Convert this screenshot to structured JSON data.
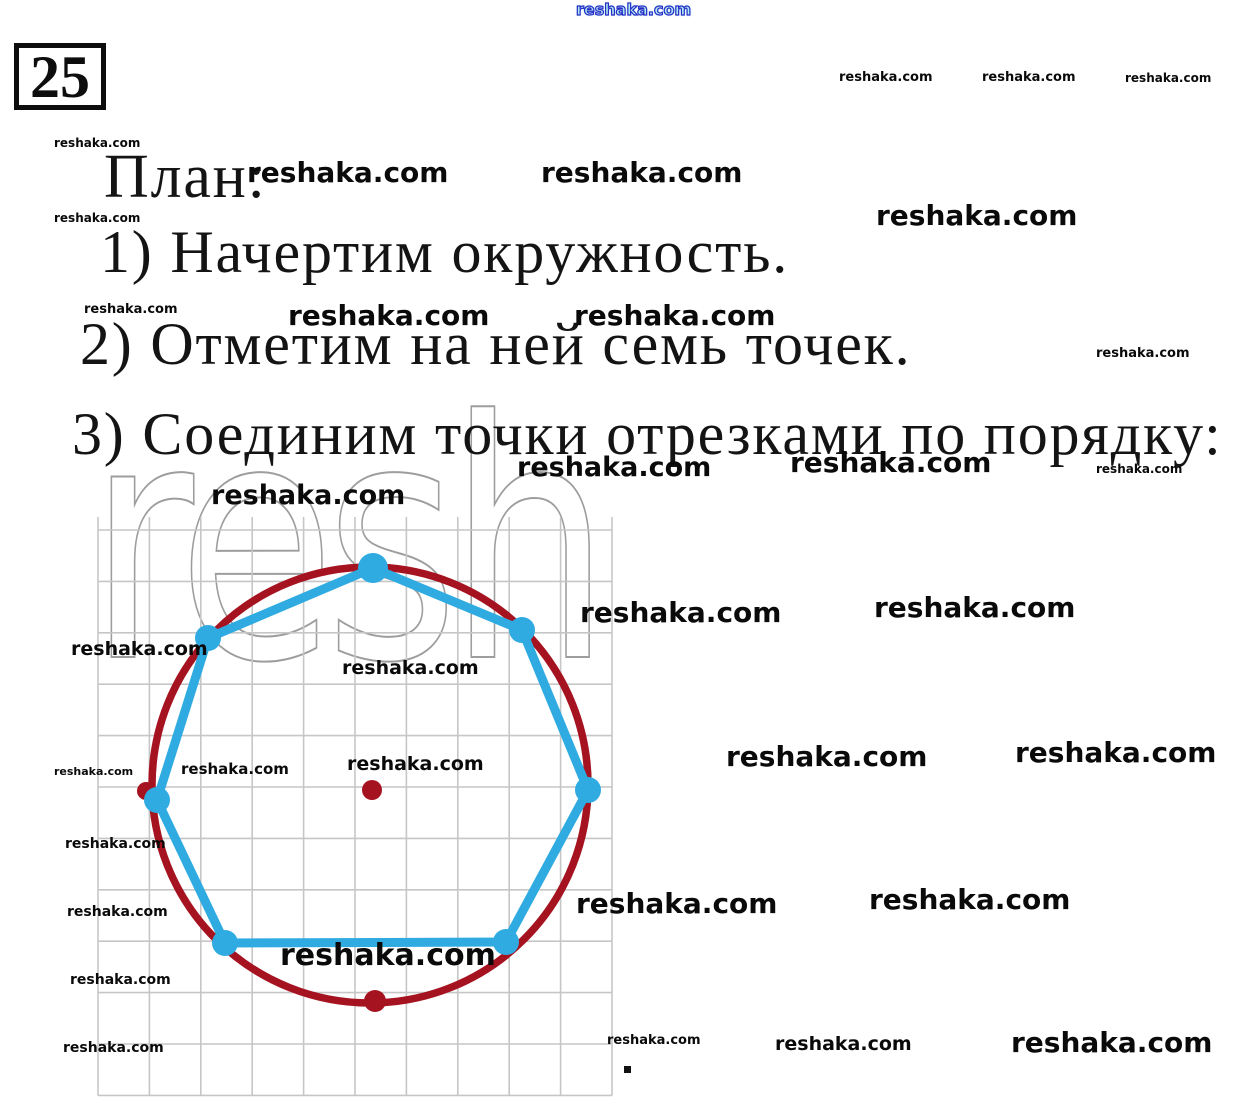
{
  "page": {
    "problem_number": "25",
    "plan_title": "План:",
    "steps": [
      "1) Начертим окружность.",
      "2) Отметим на ней семь точек.",
      "3) Соединим точки отрезками по порядку:"
    ]
  },
  "watermark": {
    "text": "reshaka.com",
    "ghost_text": "resh"
  },
  "diagram": {
    "description": "grid with dark-red circle, its dark-red center point, dark-red bottom point, and seven light-blue points on the circle joined in order by light-blue segments forming a heptagon",
    "grid": {
      "x0": 98,
      "y0": 530,
      "cols": 10,
      "rows": 11,
      "spacing": 51.4,
      "top_overhang": 13,
      "color": "#c6c6c6",
      "line_width": 1.6
    },
    "circle": {
      "cx": 370,
      "cy": 785,
      "r": 218,
      "color": "#a61320",
      "stroke_width": 7.5
    },
    "center_point": {
      "x": 372,
      "y": 790,
      "r": 10
    },
    "bottom_point": {
      "x": 375,
      "y": 1001,
      "r": 11
    },
    "left_marker_point": {
      "x": 146,
      "y": 791,
      "r": 9
    },
    "polygon": {
      "color": "#2fabe1",
      "stroke_width": 9,
      "vertex_radius": 13,
      "points": [
        [
          373,
          568
        ],
        [
          522,
          630
        ],
        [
          588,
          790
        ],
        [
          506,
          942
        ],
        [
          225,
          943
        ],
        [
          157,
          800
        ],
        [
          208,
          638
        ]
      ]
    }
  }
}
